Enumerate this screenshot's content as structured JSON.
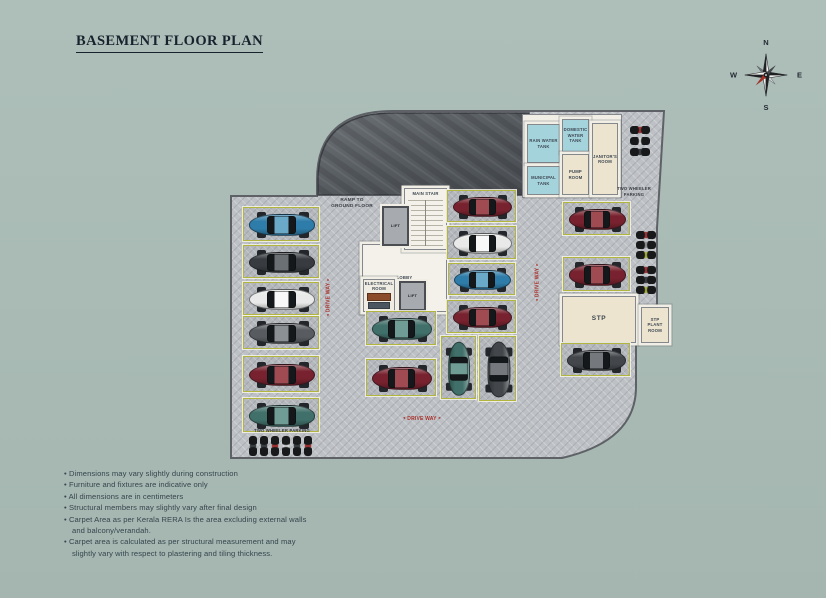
{
  "page": {
    "title": "BASEMENT FLOOR PLAN"
  },
  "compass": {
    "north": "N",
    "south": "S",
    "east": "E",
    "west": "W"
  },
  "notes": {
    "items": [
      "Dimensions may vary slightly during construction",
      "Furniture and fixtures are indicative only",
      "All dimensions are in centimeters",
      "Structural members may slightly vary after final design",
      "Carpet Area as per Kerala RERA Is the area excluding external walls and balcony/verandah.",
      "Carpet area is calculated as per structural measurement and may slightly vary with respect to plastering and tiling thickness."
    ]
  },
  "plan": {
    "colors": {
      "background": "#aabcb6",
      "floor": "#bdc0c4",
      "ramp": "#565b60",
      "wall": "#f1eee6",
      "stall_border": "#b2b63e",
      "room_blue": "#a5d3dc",
      "room_cream": "#ece4cf",
      "label_red": "#a9302b",
      "label_dark": "#3b4046"
    },
    "car_colors": {
      "blue": {
        "body": "#2e7ca9",
        "roof": "#6aa9c8"
      },
      "darkgray": {
        "body": "#383c40",
        "roof": "#6b7075"
      },
      "white": {
        "body": "#e8e9e8",
        "roof": "#f7f8f7"
      },
      "gray": {
        "body": "#585c60",
        "roof": "#8b9095"
      },
      "maroon": {
        "body": "#77222e",
        "roof": "#a04a52"
      },
      "teal": {
        "body": "#41706a",
        "roof": "#6f9c94"
      },
      "charcoal": {
        "body": "#43474b",
        "roof": "#75797d"
      }
    },
    "bike_accents": {
      "red": "#a83434",
      "white": "#d4d5d6",
      "dark": "#3c3f43",
      "gray": "#94979a",
      "lime": "#a9b23c"
    },
    "rooms": [
      {
        "label": "RAIN WATER\nTANK",
        "x": 527,
        "y": 124,
        "w": 33,
        "h": 39,
        "fill": "blue"
      },
      {
        "label": "DOMESTIC\nWATER\nTANK",
        "x": 562,
        "y": 119,
        "w": 27,
        "h": 33,
        "fill": "blue"
      },
      {
        "label": "MUNICIPAL\nTANK",
        "x": 527,
        "y": 166,
        "w": 33,
        "h": 29,
        "fill": "blue"
      },
      {
        "label": "PUMP\nROOM",
        "x": 562,
        "y": 154,
        "w": 27,
        "h": 41,
        "fill": "cream"
      },
      {
        "label": "JANITOR'S\nROOM",
        "x": 592,
        "y": 123,
        "w": 26,
        "h": 72,
        "fill": "cream"
      },
      {
        "label": "LOBBY",
        "x": 362,
        "y": 244,
        "w": 85,
        "h": 68,
        "fill": "white"
      },
      {
        "label": "MAIN STAIR",
        "x": 404,
        "y": 188,
        "w": 43,
        "h": 62,
        "fill": "white",
        "cls": "stair"
      },
      {
        "label": "LIFT",
        "x": 382,
        "y": 206,
        "w": 27,
        "h": 40,
        "fill": "lift"
      },
      {
        "label": "ELECTRICAL\nROOM",
        "x": 363,
        "y": 279,
        "w": 32,
        "h": 33,
        "fill": "white2",
        "cls": "elec"
      },
      {
        "label": "LIFT",
        "x": 399,
        "y": 281,
        "w": 27,
        "h": 30,
        "fill": "lift"
      },
      {
        "label": "STP",
        "x": 562,
        "y": 296,
        "w": 74,
        "h": 47,
        "fill": "cream",
        "cls": "big"
      },
      {
        "label": "STP\nPLANT\nROOM",
        "x": 641,
        "y": 307,
        "w": 28,
        "h": 36,
        "fill": "cream"
      }
    ],
    "stalls": [
      {
        "x": 243,
        "y": 207,
        "w": 76,
        "h": 34,
        "car": "blue"
      },
      {
        "x": 243,
        "y": 245,
        "w": 76,
        "h": 33,
        "car": "darkgray"
      },
      {
        "x": 243,
        "y": 282,
        "w": 76,
        "h": 33,
        "car": "white"
      },
      {
        "x": 243,
        "y": 316,
        "w": 76,
        "h": 33,
        "car": "gray"
      },
      {
        "x": 243,
        "y": 356,
        "w": 76,
        "h": 36,
        "car": "maroon"
      },
      {
        "x": 243,
        "y": 398,
        "w": 76,
        "h": 34,
        "car": "teal"
      },
      {
        "x": 366,
        "y": 311,
        "w": 70,
        "h": 34,
        "car": "teal"
      },
      {
        "x": 366,
        "y": 359,
        "w": 70,
        "h": 37,
        "car": "maroon"
      },
      {
        "x": 447,
        "y": 190,
        "w": 69,
        "h": 32,
        "car": "maroon"
      },
      {
        "x": 447,
        "y": 226,
        "w": 69,
        "h": 33,
        "car": "white"
      },
      {
        "x": 448,
        "y": 263,
        "w": 67,
        "h": 32,
        "car": "blue"
      },
      {
        "x": 447,
        "y": 300,
        "w": 69,
        "h": 33,
        "car": "maroon"
      },
      {
        "x": 441,
        "y": 336,
        "w": 35,
        "h": 63,
        "car": "teal",
        "orient": "v"
      },
      {
        "x": 479,
        "y": 336,
        "w": 37,
        "h": 65,
        "car": "charcoal",
        "orient": "v"
      },
      {
        "x": 563,
        "y": 202,
        "w": 67,
        "h": 33,
        "car": "maroon"
      },
      {
        "x": 563,
        "y": 257,
        "w": 67,
        "h": 34,
        "car": "maroon"
      },
      {
        "x": 561,
        "y": 343,
        "w": 69,
        "h": 33,
        "car": "charcoal"
      }
    ],
    "bike_groups": [
      {
        "x": 630,
        "y": 126,
        "dir": "h",
        "count": 3,
        "gap": 11,
        "accents": [
          "red",
          "white",
          "dark"
        ]
      },
      {
        "x": 636,
        "y": 231,
        "dir": "h",
        "count": 3,
        "gap": 10,
        "accents": [
          "red",
          "gray",
          "lime"
        ]
      },
      {
        "x": 636,
        "y": 266,
        "dir": "h",
        "count": 3,
        "gap": 10,
        "accents": [
          "red",
          "dark",
          "lime"
        ]
      },
      {
        "x": 249,
        "y": 436,
        "dir": "v",
        "count": 6,
        "gap": 11,
        "accents": [
          "dark",
          "dark",
          "red",
          "white",
          "dark",
          "red"
        ]
      }
    ],
    "labels": [
      {
        "text": "RAMP TO\nGROUND FLOOR",
        "x": 324,
        "y": 198,
        "w": 56,
        "size": 4.8,
        "color": "dark"
      },
      {
        "text": "TWO WHEELER\nPARKING",
        "x": 610,
        "y": 186,
        "w": 48,
        "size": 4.2,
        "color": "dark"
      },
      {
        "text": "TWO WHEELER PARKING",
        "x": 244,
        "y": 428,
        "w": 76,
        "size": 4.2,
        "color": "dark"
      },
      {
        "text": "DRIVE WAY",
        "x": 303,
        "y": 294,
        "w": 52,
        "size": 5,
        "color": "red",
        "rot": -90,
        "arrows": true
      },
      {
        "text": "DRIVE WAY",
        "x": 512,
        "y": 279,
        "w": 52,
        "size": 5,
        "color": "red",
        "rot": -90,
        "arrows": true
      },
      {
        "text": "DRIVE WAY",
        "x": 396,
        "y": 416,
        "w": 52,
        "size": 5,
        "color": "red",
        "arrows": true
      }
    ]
  }
}
